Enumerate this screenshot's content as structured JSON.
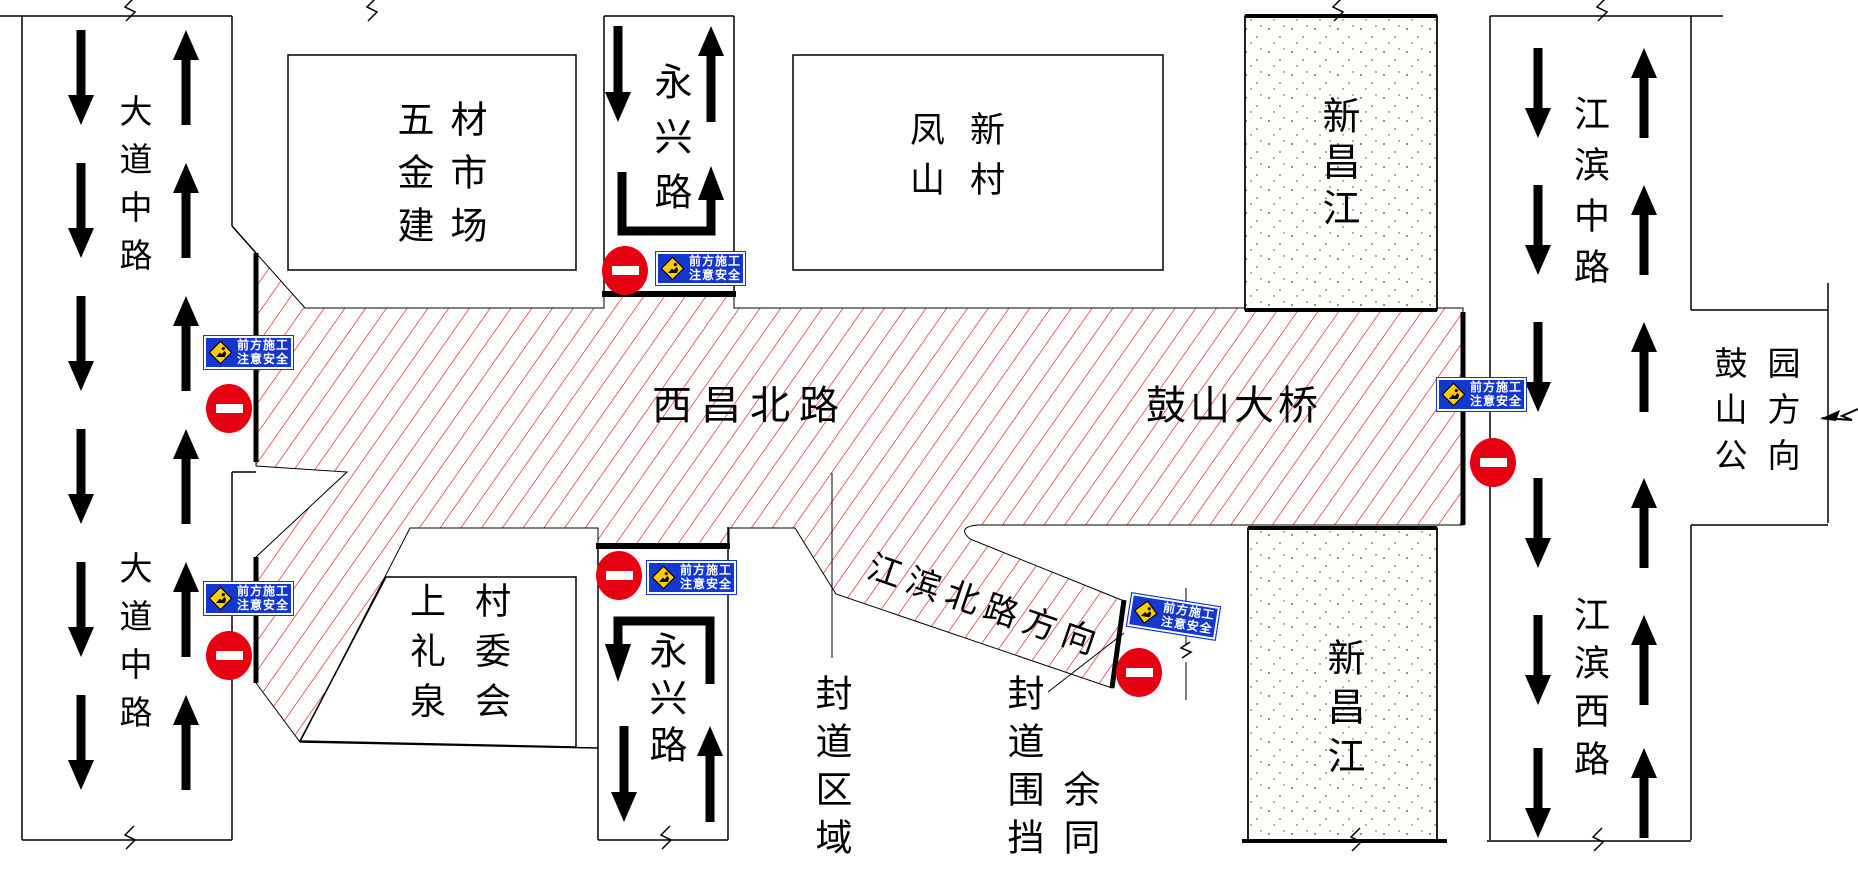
{
  "roads": {
    "dadao": {
      "name": "大道中路"
    },
    "yongxing": {
      "name": "永兴路"
    },
    "xichang": {
      "name": "西昌北路"
    },
    "gushan_bridge": {
      "name": "鼓山大桥"
    },
    "jiangbin_zhong": {
      "name": "江滨中路"
    },
    "jiangbin_xi": {
      "name": "江滨西路"
    },
    "jiangbin_bei_direction": {
      "name": "江滨北路方向"
    },
    "gushan_park_direction": {
      "col1": "鼓山公",
      "col2": "园方向"
    }
  },
  "places": {
    "hardware_market": {
      "col1": "五金建",
      "col2": "材市场"
    },
    "fengshan_village": {
      "col1": "凤山",
      "col2": "新村"
    },
    "shangliquan_committee": {
      "col1": "上礼泉",
      "col2": "村委会"
    },
    "xinchang_river": {
      "name": "新昌江"
    }
  },
  "labels": {
    "closed_area": "封道区域",
    "closure_fence": "封道围挡",
    "rest_same": "余同"
  },
  "signs": {
    "construction": {
      "line1": "前方施工",
      "line2": "注意安全"
    }
  },
  "colors": {
    "hatch_red": "#e60000",
    "sign_blue": "#1337cf",
    "sign_yellow": "#ffcc00",
    "no_entry_red": "#e60012",
    "line_black": "#000000"
  }
}
